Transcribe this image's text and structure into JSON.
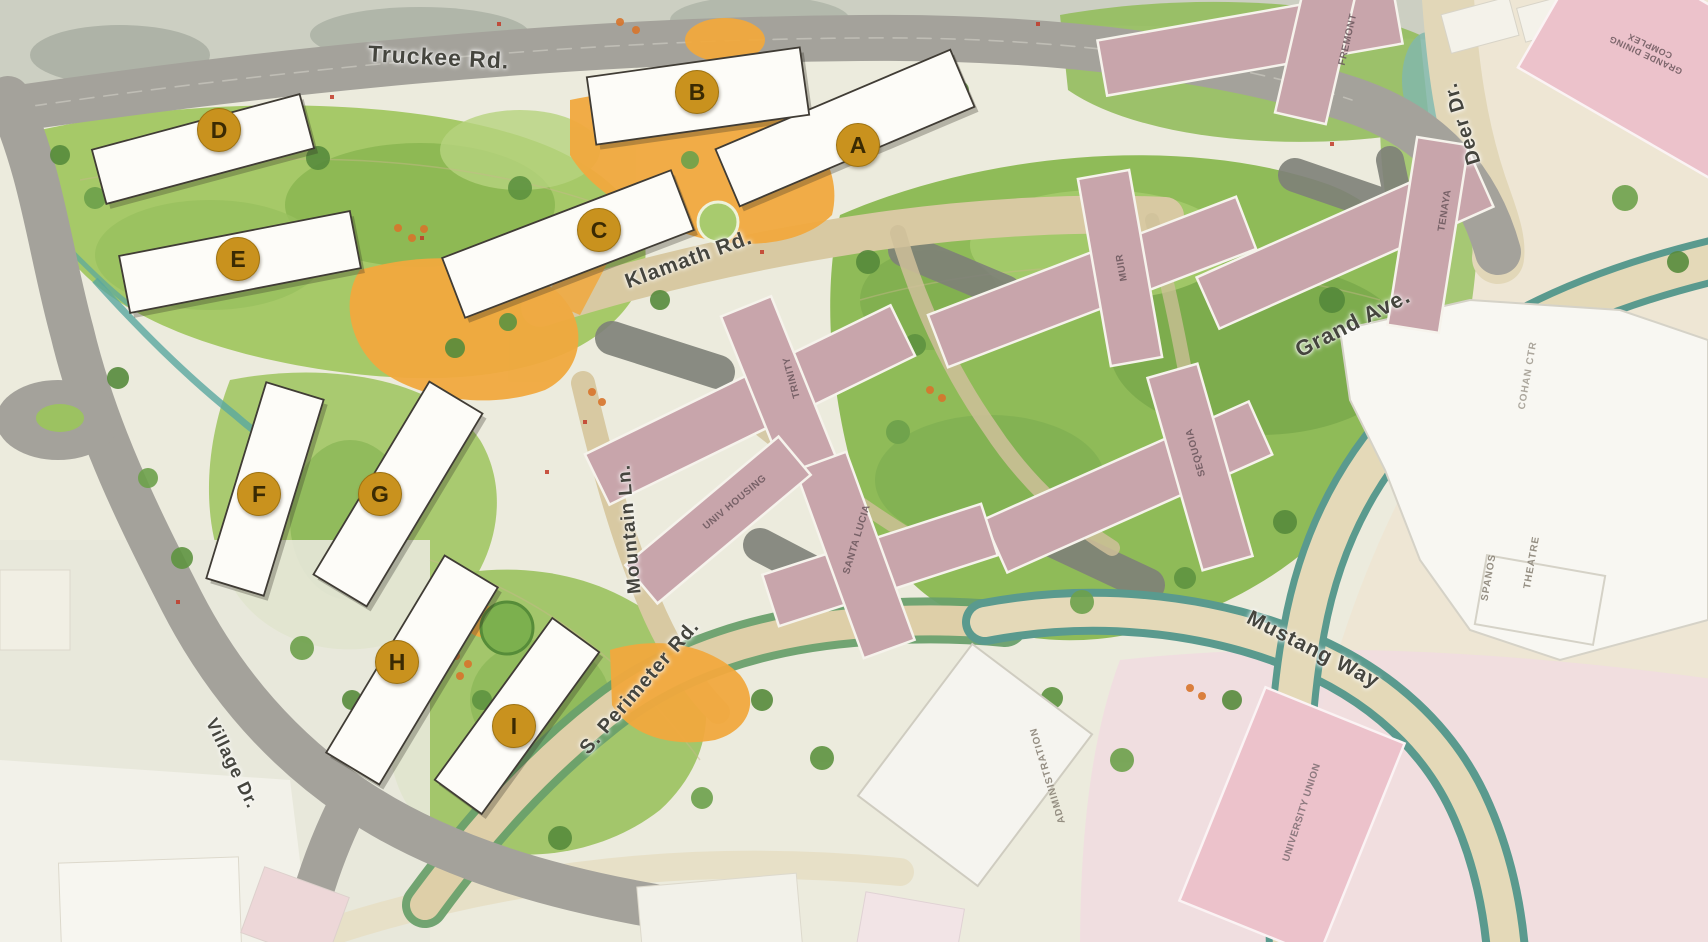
{
  "map": {
    "kind": "campus-housing-site-plan",
    "roads": [
      {
        "id": "truckee",
        "label": "Truckee Rd."
      },
      {
        "id": "klamath",
        "label": "Klamath Rd."
      },
      {
        "id": "grand",
        "label": "Grand Ave."
      },
      {
        "id": "deer",
        "label": "Deer Dr."
      },
      {
        "id": "mustang",
        "label": "Mustang Way"
      },
      {
        "id": "s-perimeter",
        "label": "S. Perimeter Rd."
      },
      {
        "id": "mountain",
        "label": "Mountain Ln."
      },
      {
        "id": "village",
        "label": "Village Dr."
      }
    ],
    "proposed_buildings": [
      {
        "letter": "A"
      },
      {
        "letter": "B"
      },
      {
        "letter": "C"
      },
      {
        "letter": "D"
      },
      {
        "letter": "E"
      },
      {
        "letter": "F"
      },
      {
        "letter": "G"
      },
      {
        "letter": "H"
      },
      {
        "letter": "I"
      }
    ],
    "existing_buildings": [
      {
        "name": "FREMONT"
      },
      {
        "name": "TENAYA"
      },
      {
        "name": "MUIR"
      },
      {
        "name": "TRINITY"
      },
      {
        "name": "SEQUOIA"
      },
      {
        "name": "SANTA LUCIA"
      },
      {
        "name": "UNIV HOUSING"
      },
      {
        "name": "GRANDE DINING COMPLEX"
      },
      {
        "name": "UNIVERSITY UNION"
      },
      {
        "name": "ADMINISTRATION"
      },
      {
        "name": "SPANOS"
      },
      {
        "name": "THEATRE"
      },
      {
        "name": "COHAN CTR"
      }
    ],
    "colors": {
      "badge_gold": "#c9921e",
      "badge_letter": "#3a2a03",
      "dorm_pink": "#c8a5ab",
      "light_pink_building": "#ecc2cb",
      "proposed_white": "#fdfcf8",
      "plaza_orange": "#f1a93e",
      "road_gray": "#a4a29b",
      "road_tan": "#d8c9a2",
      "street_tree_teal": "#5a9a8e",
      "lawn_green": "#8fbb58"
    }
  }
}
